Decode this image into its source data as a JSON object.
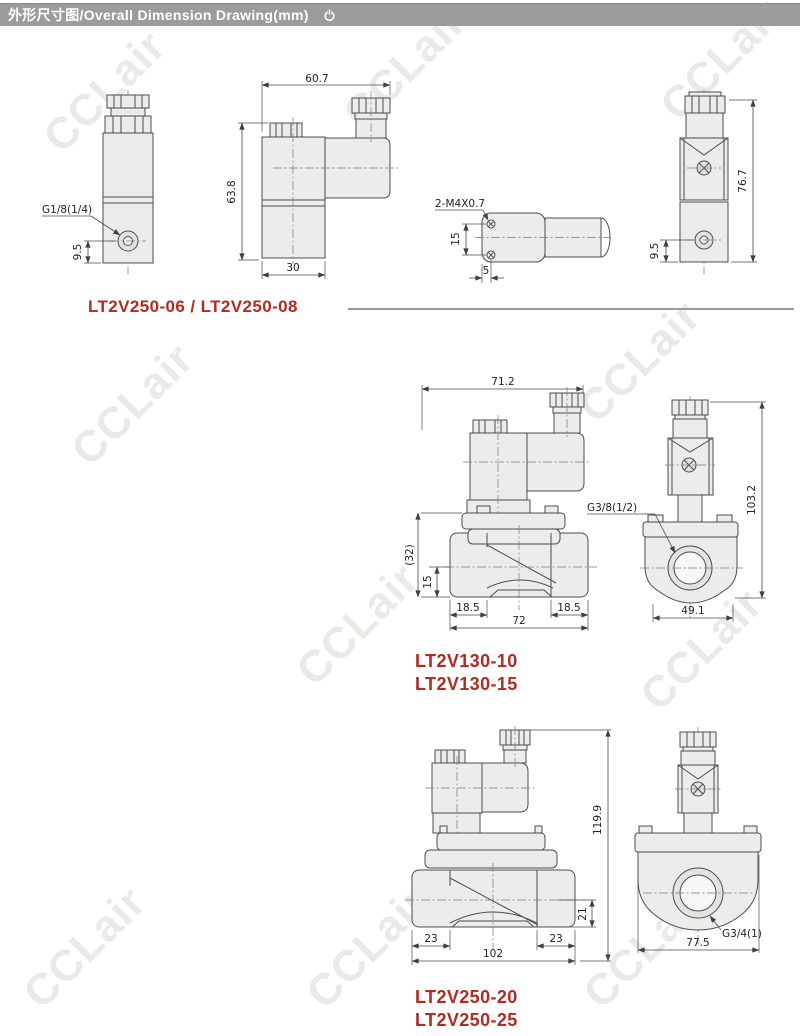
{
  "header": {
    "title": "外形尺寸图/Overall Dimension Drawing(mm)",
    "icon": "power"
  },
  "watermark": {
    "text": "CCLair",
    "color": "#e9e9e5"
  },
  "accent_red": "#b02b20",
  "groups": [
    {
      "title": "LT2V250-06 / LT2V250-08",
      "front": {
        "port_label": "G1/8(1/4)",
        "port_height": "9.5"
      },
      "side": {
        "width_top": "60.7",
        "height": "63.8",
        "width_bottom": "30"
      },
      "bottom": {
        "thread_label": "2-M4X0.7",
        "hole_spacing": "15",
        "hole_offset": "5"
      },
      "rear": {
        "height": "76.7",
        "port_height": "9.5"
      }
    },
    {
      "title_line1": "LT2V130-10",
      "title_line2": "LT2V130-15",
      "side": {
        "width_top": "71.2",
        "height_ref": "(32)",
        "port_height": "15",
        "port_left": "18.5",
        "port_right": "18.5",
        "width_bottom": "72"
      },
      "front": {
        "port_label": "G3/8(1/2)",
        "height": "103.2",
        "width_bottom": "49.1"
      }
    },
    {
      "title_line1": "LT2V250-20",
      "title_line2": "LT2V250-25",
      "side": {
        "height": "119.9",
        "port_height": "21",
        "port_left": "23",
        "port_right": "23",
        "width_bottom": "102"
      },
      "front": {
        "width_bottom": "77.5",
        "port_label": "G3/4(1)"
      }
    }
  ]
}
